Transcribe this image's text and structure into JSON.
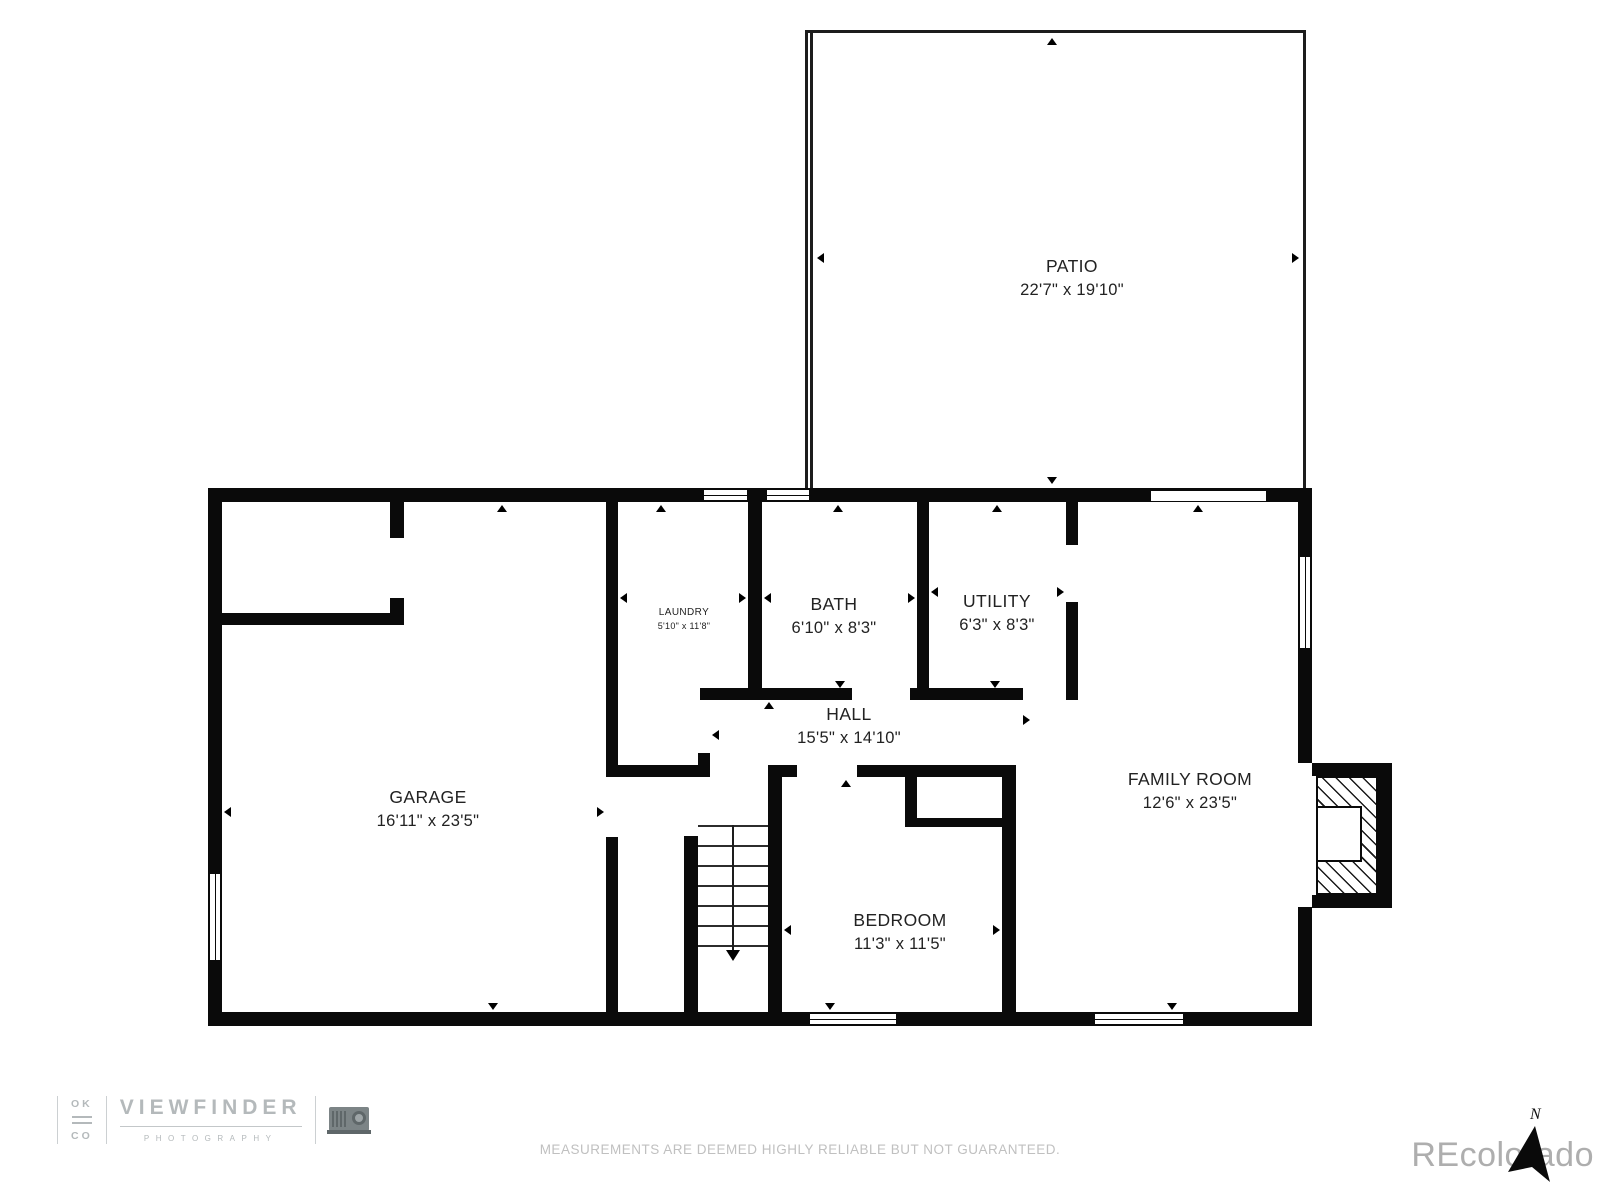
{
  "rooms": {
    "patio": {
      "name": "PATIO",
      "dims": "22'7\" x 19'10\""
    },
    "garage": {
      "name": "GARAGE",
      "dims": "16'11\" x 23'5\""
    },
    "laundry": {
      "name": "LAUNDRY",
      "dims": "5'10\" x 11'8\""
    },
    "bath": {
      "name": "BATH",
      "dims": "6'10\" x 8'3\""
    },
    "utility": {
      "name": "UTILITY",
      "dims": "6'3\" x 8'3\""
    },
    "hall": {
      "name": "HALL",
      "dims": "15'5\" x 14'10\""
    },
    "family_room": {
      "name": "FAMILY ROOM",
      "dims": "12'6\" x 23'5\""
    },
    "bedroom": {
      "name": "BEDROOM",
      "dims": "11'3\" x 11'5\""
    }
  },
  "footer": {
    "disclaimer": "MEASUREMENTS ARE DEEMED HIGHLY RELIABLE BUT NOT GUARANTEED."
  },
  "watermark": {
    "text": "REcolorado"
  },
  "logo": {
    "top": "OK",
    "bottom": "CO",
    "title": "VIEWFINDER",
    "subtitle": "PHOTOGRAPHY"
  },
  "compass": {
    "label": "N"
  },
  "colors": {
    "wall": "#0a0a0a",
    "label_text": "#222222",
    "muted_text": "#c0c0c0",
    "logo_gray": "#b4b9bb",
    "watermark_gray": "#aeaeae"
  }
}
